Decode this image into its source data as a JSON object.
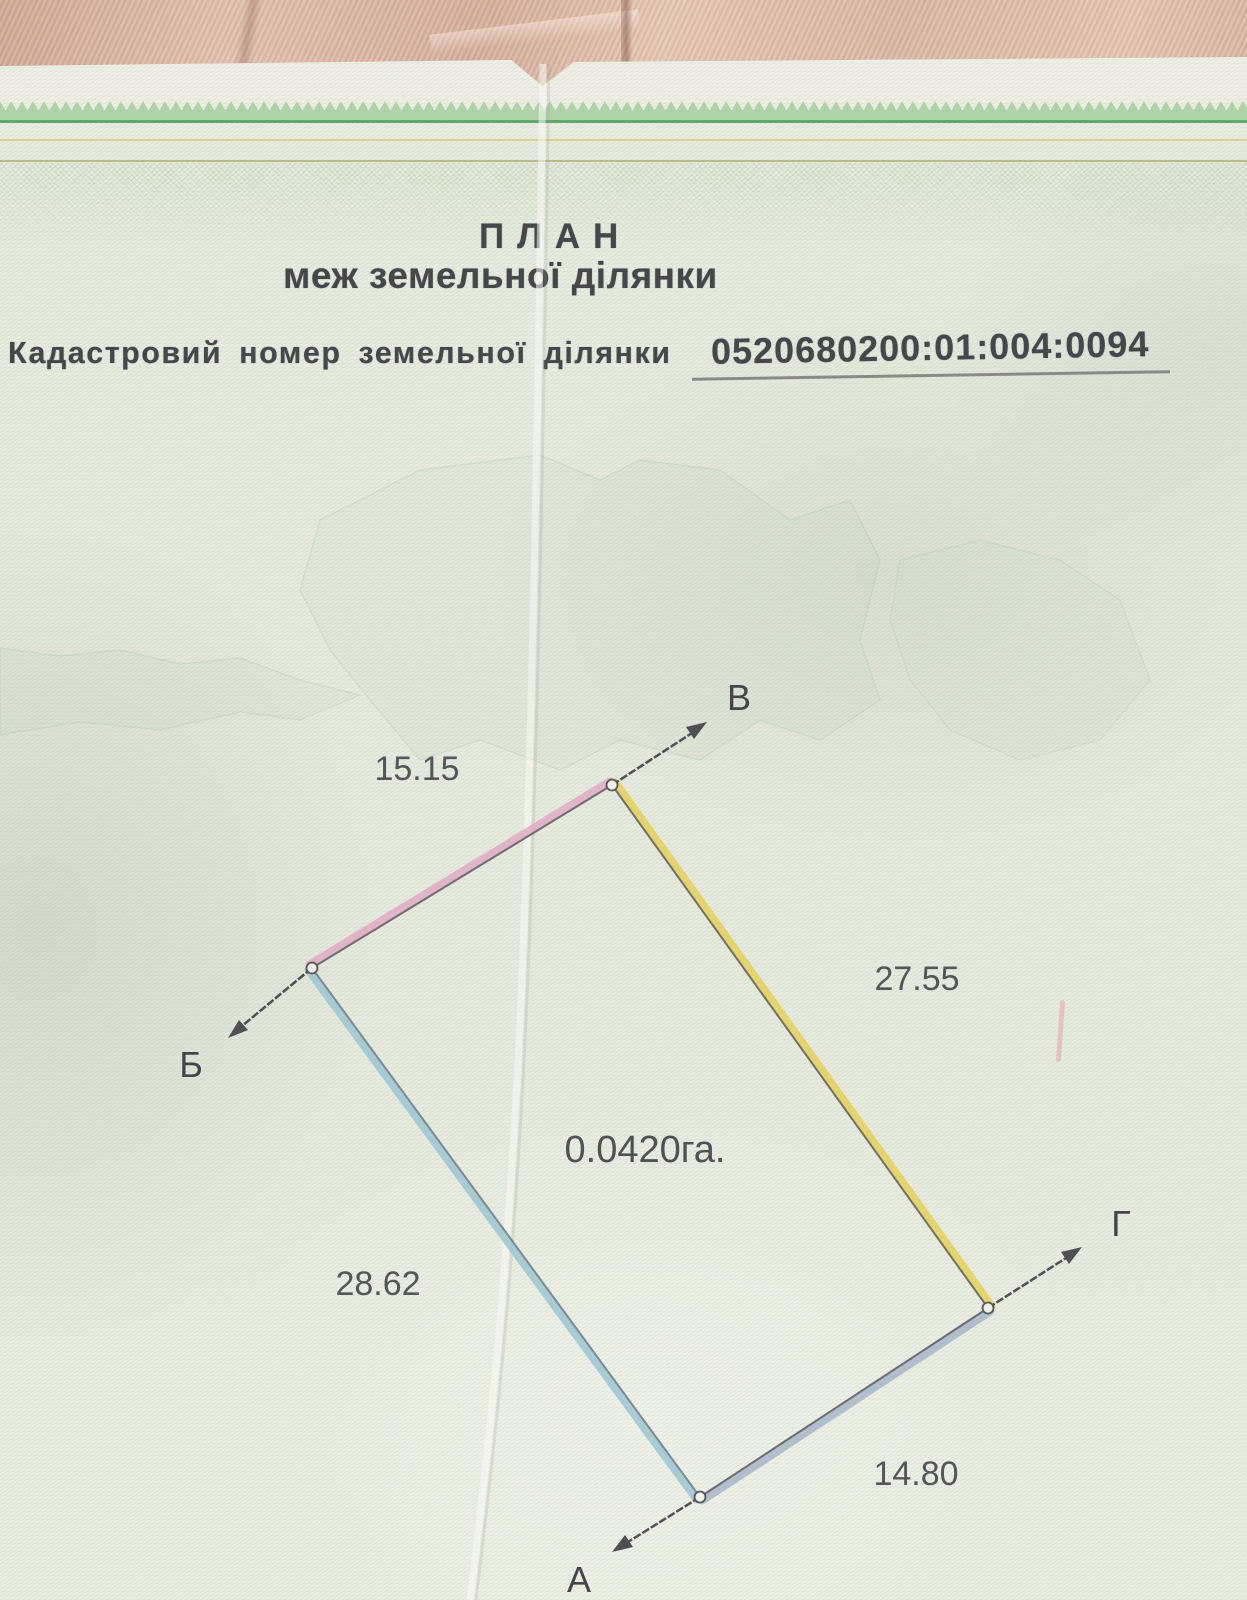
{
  "page": {
    "title_line1": "ПЛАН",
    "title_line2": "меж земельної ділянки",
    "cadastral_label": "Кадастровий номер земельної ділянки",
    "cadastral_number": "0520680200:01:004:0094"
  },
  "plan": {
    "area": "0.0420га.",
    "corners": {
      "v": "В",
      "b": "Б",
      "a": "А",
      "g": "Г"
    },
    "sides": [
      {
        "from": "Б",
        "to": "В",
        "length": "15.15",
        "color": "#dfa7c3"
      },
      {
        "from": "В",
        "to": "Г",
        "length": "27.55",
        "color": "#e2cf52"
      },
      {
        "from": "Б",
        "to": "А",
        "length": "28.62",
        "color": "#9cc6d4"
      },
      {
        "from": "А",
        "to": "Г",
        "length": "14.80",
        "color": "#a2b3c6"
      }
    ]
  },
  "colors": {
    "security_border_green": "#4c9a55",
    "paper_tint": "#e9ece0",
    "fabric": "#d8b4a3"
  }
}
